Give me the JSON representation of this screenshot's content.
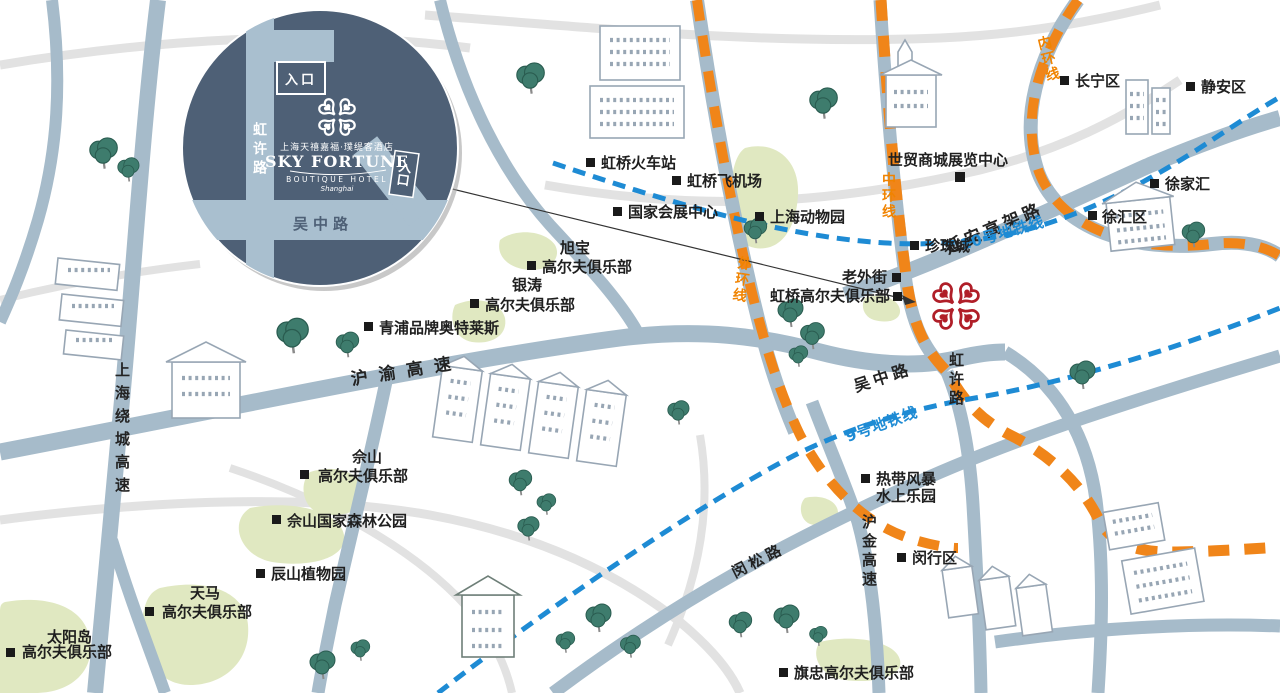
{
  "hotel_inset": {
    "entrance_top_label": "入口",
    "entrance_side_label": "入口",
    "road_vertical": "虹许路",
    "road_horizontal": "吴中路",
    "brand_name_cn": "上海天禧嘉福·璞缇客酒店",
    "brand_name_en": "SKY FORTUNE",
    "brand_subtitle": "BOUTIQUE HOTEL",
    "brand_script": "Shanghai"
  },
  "roads": {
    "huyu_expwy": "沪渝高速",
    "yanan_elevated": "延安高架路",
    "wuzhong_rd": "吴中路",
    "hongxu_rd": "虹许路",
    "raocheng_expwy": "上海绕城高速",
    "hujin_expwy": "沪金高速",
    "minsong_rd": "闵松路"
  },
  "ring_roads": {
    "inner": "内环线",
    "middle": "中环线",
    "outer": "外环线"
  },
  "metro_lines": {
    "line_10": "10号地铁线",
    "line_9": "9号地铁线"
  },
  "pois": [
    {
      "label": "虹桥火车站"
    },
    {
      "label": "虹桥飞机场"
    },
    {
      "label": "国家会展中心"
    },
    {
      "label": "上海动物园"
    },
    {
      "label": "世贸商城展览中心"
    },
    {
      "label": "珍珠城"
    },
    {
      "label": "老外街"
    },
    {
      "label": "虹桥高尔夫俱乐部"
    },
    {
      "label": "长宁区"
    },
    {
      "label": "静安区"
    },
    {
      "label": "徐家汇"
    },
    {
      "label": "徐汇区"
    },
    {
      "label_line1": "旭宝",
      "label_line2": "高尔夫俱乐部"
    },
    {
      "label_line1": "银涛",
      "label_line2": "高尔夫俱乐部"
    },
    {
      "label": "青浦品牌奥特莱斯"
    },
    {
      "label_line1": "佘山",
      "label_line2": "高尔夫俱乐部"
    },
    {
      "label": "佘山国家森林公园"
    },
    {
      "label": "辰山植物园"
    },
    {
      "label_line1": "天马",
      "label_line2": "高尔夫俱乐部"
    },
    {
      "label_line1": "太阳岛",
      "label_line2": "高尔夫俱乐部"
    },
    {
      "label_line1": "热带风暴",
      "label_line2": "水上乐园"
    },
    {
      "label": "闵行区"
    },
    {
      "label": "旗忠高尔夫俱乐部"
    }
  ],
  "colors": {
    "main_road": "#a6bbca",
    "minor_road": "#e2e2e2",
    "ring_road_orange": "#f08519",
    "metro_blue": "#1e8bd4",
    "golf_green": "#e0e8c1",
    "tree_green": "#3e7c6d",
    "clover_red": "#b01e28",
    "inset_background": "#4e6076",
    "inset_road": "#a9bfcf",
    "label_black": "#1f1f1f"
  }
}
